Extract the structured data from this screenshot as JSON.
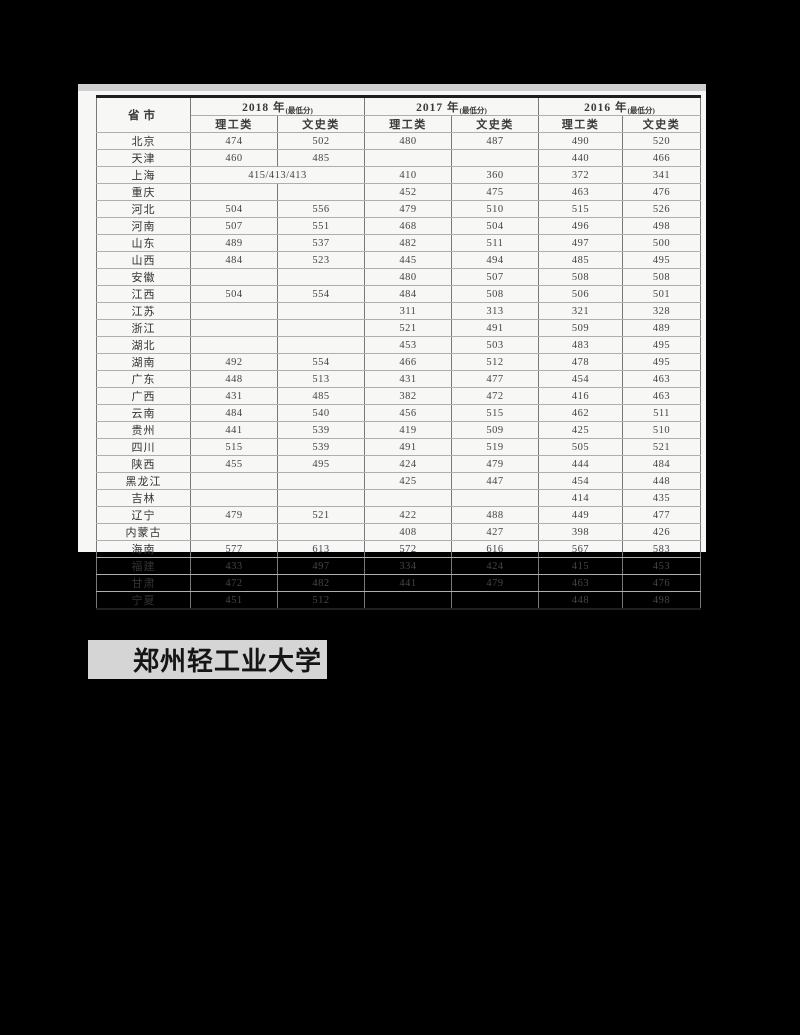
{
  "colors": {
    "page_background": "#000000",
    "panel_background": "#f7f7f6",
    "scan_edge": "#cfcfcf",
    "table_heavy_border": "#1f1f1f",
    "table_vertical_line": "#787878",
    "table_horizontal_line": "#aeaeae",
    "table_text": "#3a3a3a",
    "banner_background": "#d5d5d5",
    "banner_text": "#151515"
  },
  "table": {
    "header": {
      "province_label": "省市",
      "year_groups": [
        {
          "year": "2018 年",
          "note": "(最低分)"
        },
        {
          "year": "2017 年",
          "note": "(最低分)"
        },
        {
          "year": "2016 年",
          "note": "(最低分)"
        }
      ],
      "category_labels": [
        "理工类",
        "文史类"
      ]
    },
    "rows": [
      {
        "province": "北京",
        "scores": [
          "474",
          "502",
          "480",
          "487",
          "490",
          "520"
        ]
      },
      {
        "province": "天津",
        "scores": [
          "460",
          "485",
          "",
          "",
          "440",
          "466"
        ]
      },
      {
        "province": "上海",
        "merge_2018": true,
        "scores": [
          "415/413/413",
          "",
          "410",
          "360",
          "372",
          "341"
        ]
      },
      {
        "province": "重庆",
        "scores": [
          "",
          "",
          "452",
          "475",
          "463",
          "476"
        ]
      },
      {
        "province": "河北",
        "scores": [
          "504",
          "556",
          "479",
          "510",
          "515",
          "526"
        ]
      },
      {
        "province": "河南",
        "scores": [
          "507",
          "551",
          "468",
          "504",
          "496",
          "498"
        ]
      },
      {
        "province": "山东",
        "scores": [
          "489",
          "537",
          "482",
          "511",
          "497",
          "500"
        ]
      },
      {
        "province": "山西",
        "scores": [
          "484",
          "523",
          "445",
          "494",
          "485",
          "495"
        ]
      },
      {
        "province": "安徽",
        "scores": [
          "",
          "",
          "480",
          "507",
          "508",
          "508"
        ]
      },
      {
        "province": "江西",
        "scores": [
          "504",
          "554",
          "484",
          "508",
          "506",
          "501"
        ]
      },
      {
        "province": "江苏",
        "scores": [
          "",
          "",
          "311",
          "313",
          "321",
          "328"
        ]
      },
      {
        "province": "浙江",
        "scores": [
          "",
          "",
          "521",
          "491",
          "509",
          "489"
        ]
      },
      {
        "province": "湖北",
        "scores": [
          "",
          "",
          "453",
          "503",
          "483",
          "495"
        ]
      },
      {
        "province": "湖南",
        "scores": [
          "492",
          "554",
          "466",
          "512",
          "478",
          "495"
        ]
      },
      {
        "province": "广东",
        "scores": [
          "448",
          "513",
          "431",
          "477",
          "454",
          "463"
        ]
      },
      {
        "province": "广西",
        "scores": [
          "431",
          "485",
          "382",
          "472",
          "416",
          "463"
        ]
      },
      {
        "province": "云南",
        "scores": [
          "484",
          "540",
          "456",
          "515",
          "462",
          "511"
        ]
      },
      {
        "province": "贵州",
        "scores": [
          "441",
          "539",
          "419",
          "509",
          "425",
          "510"
        ]
      },
      {
        "province": "四川",
        "scores": [
          "515",
          "539",
          "491",
          "519",
          "505",
          "521"
        ]
      },
      {
        "province": "陕西",
        "scores": [
          "455",
          "495",
          "424",
          "479",
          "444",
          "484"
        ]
      },
      {
        "province": "黑龙江",
        "scores": [
          "",
          "",
          "425",
          "447",
          "454",
          "448"
        ]
      },
      {
        "province": "吉林",
        "scores": [
          "",
          "",
          "",
          "",
          "414",
          "435"
        ]
      },
      {
        "province": "辽宁",
        "scores": [
          "479",
          "521",
          "422",
          "488",
          "449",
          "477"
        ]
      },
      {
        "province": "内蒙古",
        "scores": [
          "",
          "",
          "408",
          "427",
          "398",
          "426"
        ]
      },
      {
        "province": "海南",
        "scores": [
          "577",
          "613",
          "572",
          "616",
          "567",
          "583"
        ]
      },
      {
        "province": "福建",
        "scores": [
          "433",
          "497",
          "334",
          "424",
          "415",
          "453"
        ]
      },
      {
        "province": "甘肃",
        "scores": [
          "472",
          "482",
          "441",
          "479",
          "463",
          "476"
        ]
      },
      {
        "province": "宁夏",
        "scores": [
          "451",
          "512",
          "",
          "",
          "448",
          "498"
        ]
      }
    ]
  },
  "footer": {
    "university": "郑州轻工业大学"
  }
}
